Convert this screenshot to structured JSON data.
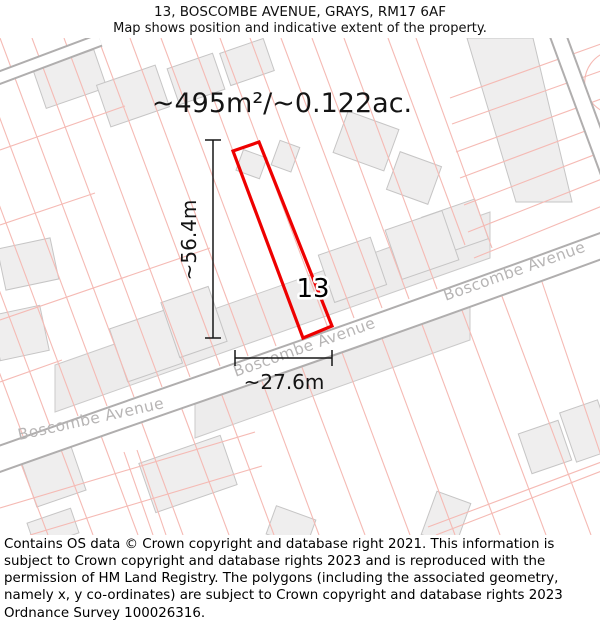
{
  "header": {
    "title": "13, BOSCOMBE AVENUE, GRAYS, RM17 6AF",
    "subtitle": "Map shows position and indicative extent of the property."
  },
  "map": {
    "area_label": "~495m²/~0.122ac.",
    "plot_number": "13",
    "vertical_dimension": "~56.4m",
    "horizontal_dimension": "~27.6m",
    "street_name": "Boscombe Avenue",
    "colors": {
      "property_outline": "#ee0000",
      "parcel_line": "#f5bab4",
      "road_casing": "#b0aeae",
      "building_fill": "#efeeee",
      "building_stroke": "#c6c5c5",
      "street_label": "#b7b5b5",
      "dimension_text": "#141414"
    }
  },
  "footer": {
    "text": "Contains OS data © Crown copyright and database right 2021. This information is subject to Crown copyright and database rights 2023 and is reproduced with the permission of HM Land Registry. The polygons (including the associated geometry, namely x, y co-ordinates) are subject to Crown copyright and database rights 2023 Ordnance Survey 100026316."
  }
}
